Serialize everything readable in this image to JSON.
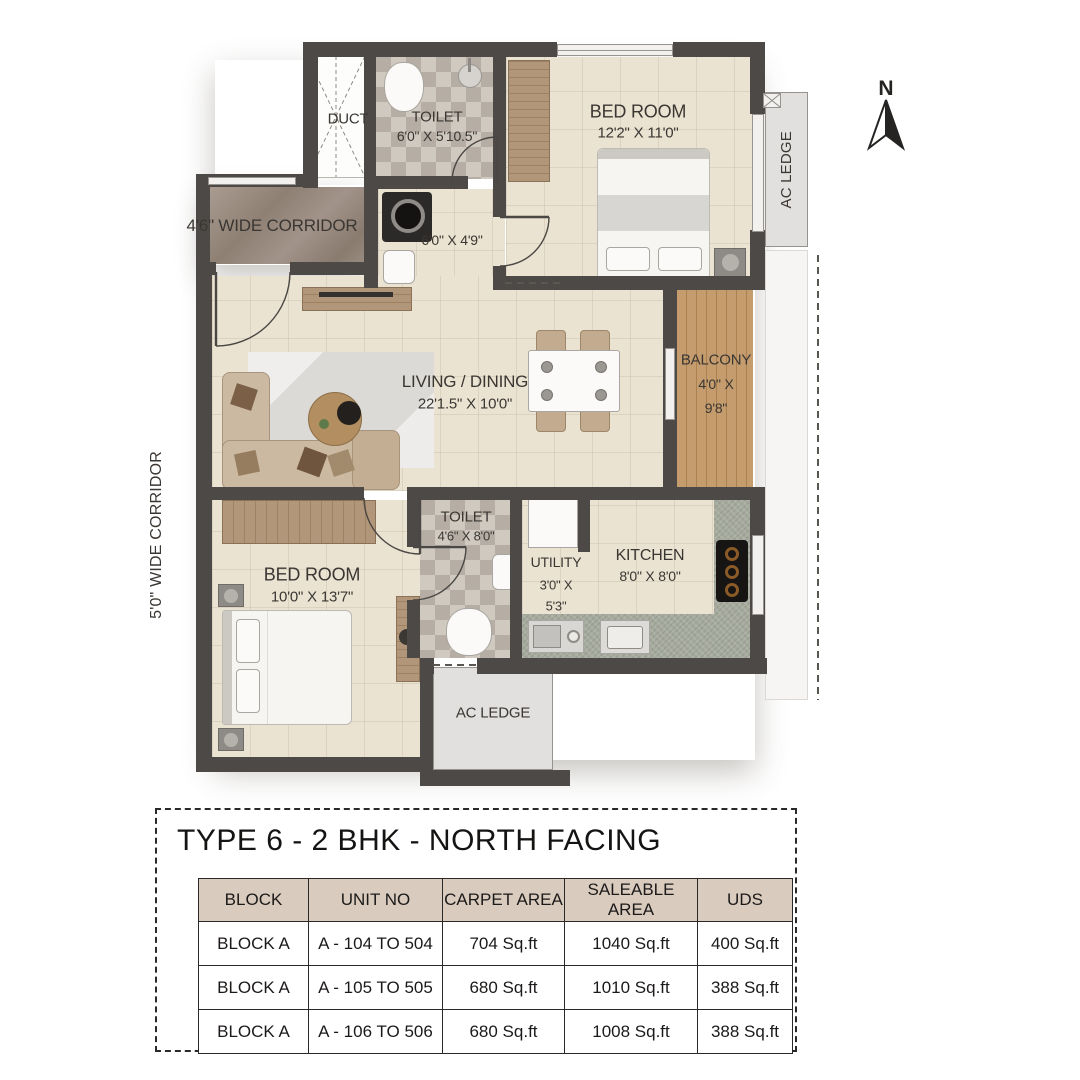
{
  "plan": {
    "compass_label": "N",
    "corridor_left": "5'0\" WIDE CORRIDOR",
    "corridor_top": "4'6\" WIDE CORRIDOR",
    "duct": "DUCT",
    "toilet_top": {
      "name": "TOILET",
      "dims": "6'0\" X 5'10.5\""
    },
    "bedroom_top": {
      "name": "BED ROOM",
      "dims": "12'2\" X 11'0\""
    },
    "foyer_dims": "6'0\" X 4'9\"",
    "living": {
      "name": "LIVING / DINING",
      "dims": "22'1.5\" X 10'0\""
    },
    "balcony": {
      "name": "BALCONY",
      "dims_line1": "4'0\" X",
      "dims_line2": "9'8\""
    },
    "toilet_bottom": {
      "name": "TOILET",
      "dims": "4'6\" X 8'0\""
    },
    "utility": {
      "name": "UTILITY",
      "dims_line1": "3'0\" X",
      "dims_line2": "5'3\""
    },
    "kitchen": {
      "name": "KITCHEN",
      "dims": "8'0\" X 8'0\""
    },
    "bedroom_bottom": {
      "name": "BED ROOM",
      "dims": "10'0\" X 13'7\""
    },
    "ac_ledge_right": "AC LEDGE",
    "ac_ledge_bottom": "AC LEDGE"
  },
  "info": {
    "title": "TYPE 6 - 2 BHK - NORTH FACING",
    "table": {
      "headers": [
        "BLOCK",
        "UNIT NO",
        "CARPET AREA",
        "SALEABLE AREA",
        "UDS"
      ],
      "rows": [
        [
          "BLOCK A",
          "A - 104 TO 504",
          "704 Sq.ft",
          "1040 Sq.ft",
          "400 Sq.ft"
        ],
        [
          "BLOCK A",
          "A - 105 TO 505",
          "680 Sq.ft",
          "1010 Sq.ft",
          "388 Sq.ft"
        ],
        [
          "BLOCK A",
          "A - 106 TO 506",
          "680 Sq.ft",
          "1008 Sq.ft",
          "388 Sq.ft"
        ]
      ]
    }
  },
  "colors": {
    "wall": "#4d4946",
    "floor": "#ebe3d2",
    "balcony_wood": "#c59c6d",
    "table_header_bg": "#d9cbbe"
  }
}
